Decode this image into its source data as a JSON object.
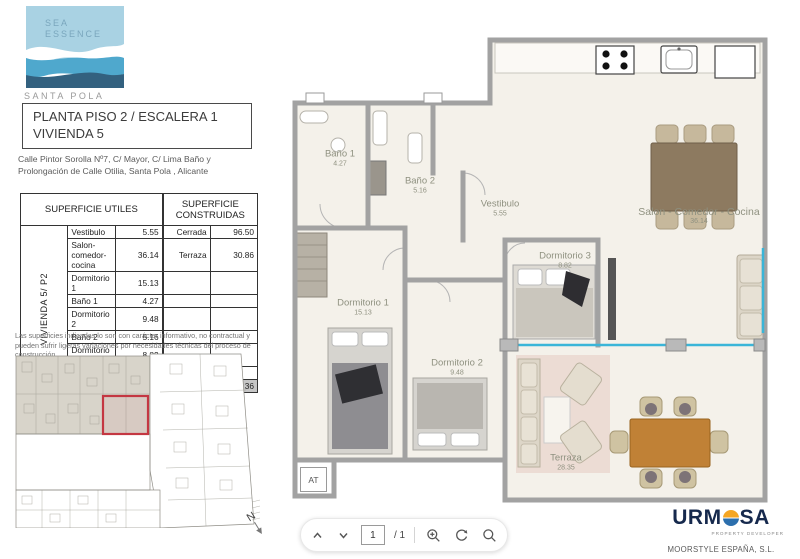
{
  "branding": {
    "logo_line1": "SEA",
    "logo_line2": "ESSENCE",
    "logo_city": "SANTA POLA"
  },
  "title_block": {
    "line1": "PLANTA PISO 2 / ESCALERA 1",
    "line2": "VIVIENDA 5"
  },
  "address_line1": "Calle Pintor Sorolla Nº7, C/ Mayor, C/ Lima Baño y",
  "address_line2": "Prolongación de Calle Otilia, Santa Pola , Alicante",
  "areas_table": {
    "vertical_label": "VIVIENDA 5/ P2",
    "header_utiles": "SUPERFICIE UTILES",
    "header_construidas": "SUPERFICIE CONSTRUIDAS",
    "rows": [
      {
        "name": "Vestibulo",
        "value": "5.55",
        "cname": "Cerrada",
        "cvalue": "96.50"
      },
      {
        "name": "Salon-comedor-cocina",
        "value": "36.14",
        "cname": "Terraza",
        "cvalue": "30.86"
      },
      {
        "name": "Dormitorio 1",
        "value": "15.13",
        "cname": "",
        "cvalue": ""
      },
      {
        "name": "Baño 1",
        "value": "4.27",
        "cname": "",
        "cvalue": ""
      },
      {
        "name": "Dormitorio 2",
        "value": "9.48",
        "cname": "",
        "cvalue": ""
      },
      {
        "name": "Baño 2",
        "value": "5.16",
        "cname": "",
        "cvalue": ""
      },
      {
        "name": "Dormitorio 3",
        "value": "8.82",
        "cname": "",
        "cvalue": ""
      },
      {
        "name": "Terraza",
        "value": "28.35",
        "cname": "",
        "cvalue": ""
      }
    ],
    "total_label": "TOTAL",
    "total_utiles": "107.35",
    "total_construidas": "127.36"
  },
  "disclaimer": "Las superficies indicadas lo son con carácter informativo, no contractual y pueden sufrir ligeras variaciones por necesidades técnicas del proceso de construcción",
  "floor_plan": {
    "rooms": [
      {
        "name": "Baño 1",
        "area": "4.27"
      },
      {
        "name": "Baño 2",
        "area": "5.16"
      },
      {
        "name": "Vestibulo",
        "area": "5.55"
      },
      {
        "name": "Salon - Comedor - Cocina",
        "area": "36.14"
      },
      {
        "name": "Dormitorio 3",
        "area": "8.82"
      },
      {
        "name": "Dormitorio 1",
        "area": "15.13"
      },
      {
        "name": "Dormitorio 2",
        "area": "9.48"
      },
      {
        "name": "Terraza",
        "area": "28.35"
      }
    ],
    "tag_at": "AT"
  },
  "compass_label": "N",
  "toolbar": {
    "page_value": "1",
    "page_total": "/ 1"
  },
  "developer": {
    "brand_left": "URM",
    "brand_right": "SA",
    "tagline": "PROPERTY DEVELOPER",
    "company": "MOORSTYLE ESPAÑA, S.L."
  },
  "colors": {
    "highlight_red": "#c43742",
    "window_cyan": "#3ab5d8",
    "wall_grey": "#a2a2a2",
    "floor_cream": "#f4f1ea",
    "brand_navy": "#16294d",
    "brand_orange": "#f5a623",
    "brand_sea_blue": "#2c6fad",
    "logo_light_blue": "#a9d2e3",
    "logo_mid_blue": "#4fa8cd",
    "logo_dark_blue": "#33617f"
  }
}
